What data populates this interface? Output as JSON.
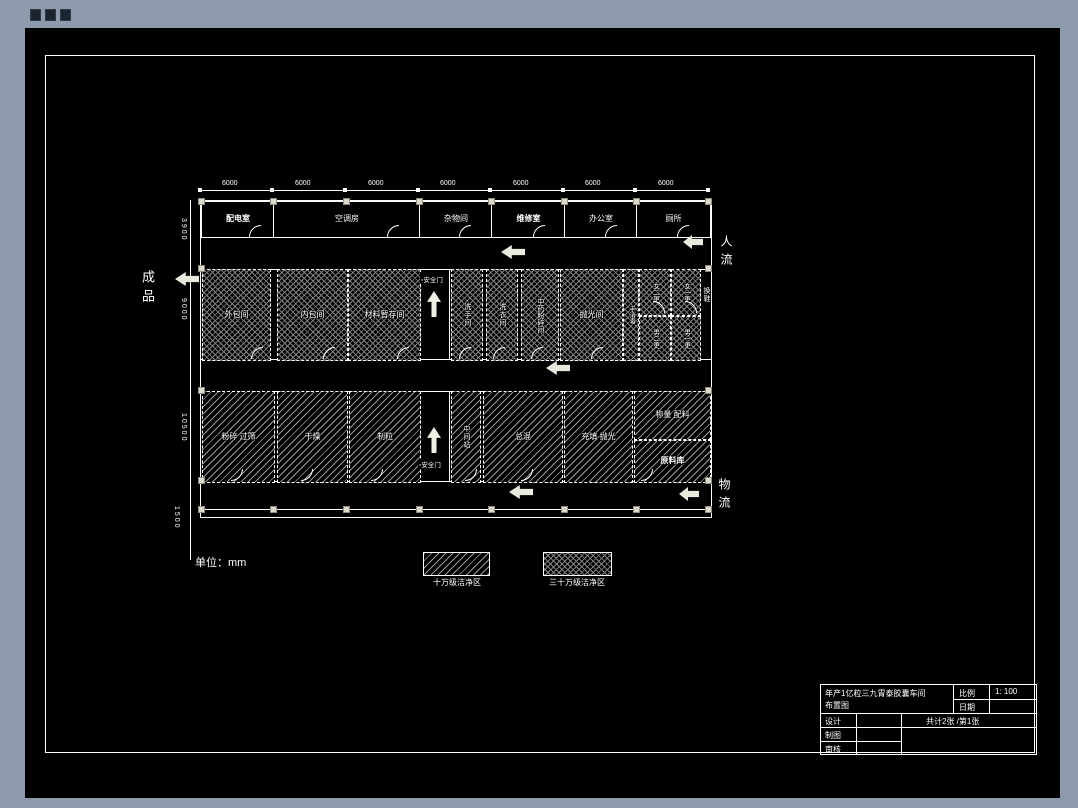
{
  "rooms": {
    "top": [
      "配电室",
      "空调房",
      "杂物间",
      "维修室",
      "办公室",
      "厕所"
    ],
    "mid_left": [
      "外包间",
      "内包间",
      "材料暂存间"
    ],
    "mid_right": [
      "洗手间",
      "洗衣间",
      "中药粉碎间",
      "抛光间"
    ],
    "changing": [
      "手消毒",
      "女二更",
      "女一更",
      "男二更",
      "男一更",
      "换鞋"
    ],
    "bottom_left": [
      "粉碎 过筛",
      "干燥",
      "制粒"
    ],
    "bottom_right": [
      "中间站",
      "总混",
      "充填 抛光",
      "称量 配料",
      "原料库"
    ]
  },
  "corridor": {
    "safety_top": "安全门",
    "safety_bottom": "安全门"
  },
  "flows": {
    "finished": "成品",
    "people": "人流",
    "material": "物流"
  },
  "dims": {
    "top": [
      "6000",
      "6000",
      "6000",
      "6000",
      "6000",
      "6000",
      "6000"
    ],
    "left": [
      "3900",
      "9000",
      "10500",
      "1500"
    ]
  },
  "unit_note": "单位：mm",
  "legend": {
    "class100k": "十万级洁净区",
    "class300k": "三十万级洁净区"
  },
  "titleblock": {
    "title_line1": "年产1亿粒三九胃泰胶囊车间",
    "title_line2": "布置图",
    "scale_label": "比例",
    "scale_value": "1: 100",
    "date_label": "日期",
    "design_label": "设计",
    "draft_label": "制图",
    "review_label": "审核",
    "sheet_info": "共计2张 /第1张"
  },
  "colors": {
    "desktop_gray": "#8d9aab",
    "canvas_black": "#000000",
    "line_white": "#ffffff",
    "hatch_gray": "#9a9a9a",
    "arrow_cream": "#e9e9dd"
  }
}
